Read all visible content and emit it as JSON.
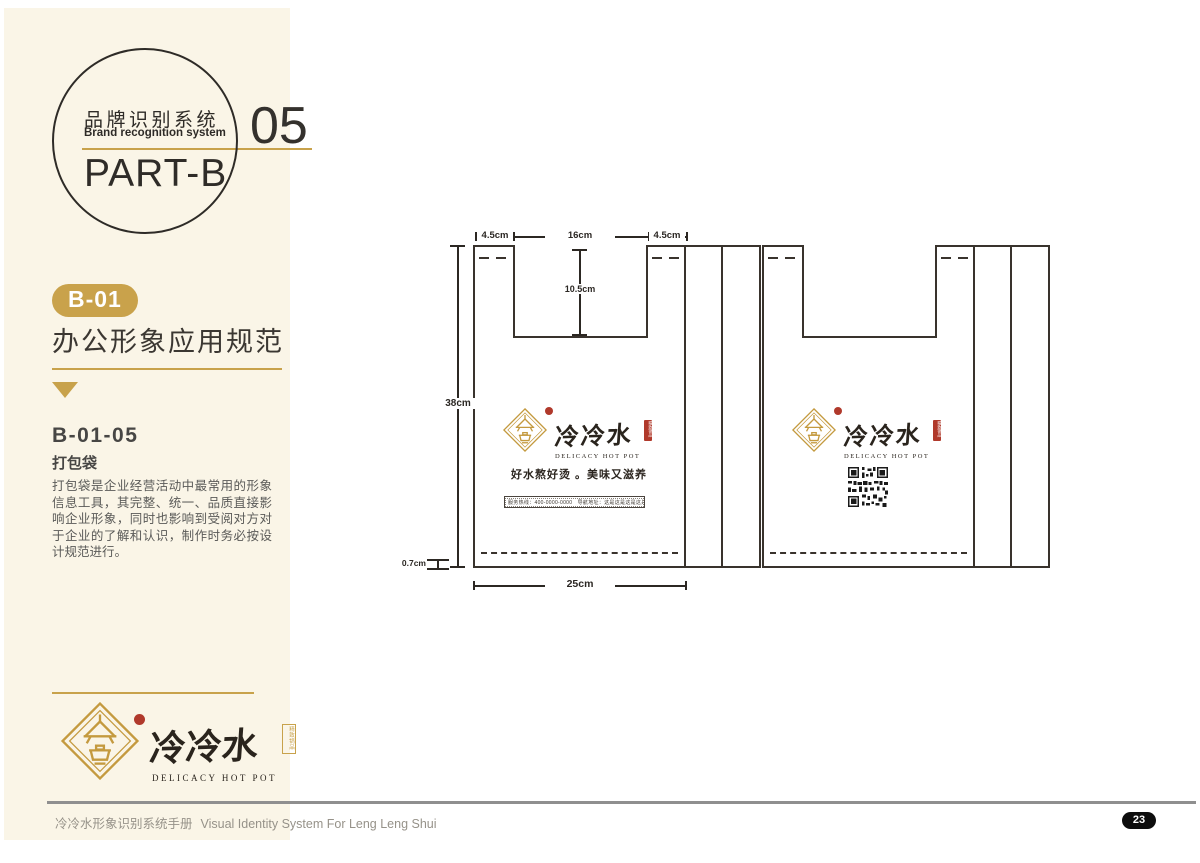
{
  "sidebar": {
    "circle": {
      "title_zh": "品牌识别系统",
      "title_en": "Brand recognition system",
      "part": "PART-B"
    },
    "chapter_number": "05",
    "section_badge": "B-01",
    "section_title": "办公形象应用规范",
    "item_code": "B-01-05",
    "item_name": "打包袋",
    "description": "打包袋是企业经营活动中最常用的形象信息工具，其完整、统一、品质直接影响企业形象，同时也影响到受阅对方对于企业的了解和认识，制作时务必按设计规范进行。"
  },
  "logo": {
    "name_zh": "冷冷水",
    "name_en": "DELICACY HOT POT",
    "seal_text": "精致锅品"
  },
  "diagram": {
    "dims": {
      "handle_left": "4.5cm",
      "opening": "16cm",
      "handle_right": "4.5cm",
      "opening_depth": "10.5cm",
      "bag_height": "38cm",
      "bottom_fold": "0.7cm",
      "bag_width": "25cm"
    },
    "bag_front": {
      "slogan": "好水熬好烫 。美味又滋养",
      "info_bar": "服务热线：400-0000-0000　导航地址：这是这是这是这是这是这是这是这是这是"
    }
  },
  "footer": {
    "text_zh": "冷冷水形象识别系统手册",
    "text_en": "Visual Identity System For Leng Leng Shui",
    "page_number": "23"
  },
  "colors": {
    "cream": "#faf5e7",
    "gold": "#c8a24b",
    "ink": "#39332d",
    "seal_red": "#b0392b"
  }
}
